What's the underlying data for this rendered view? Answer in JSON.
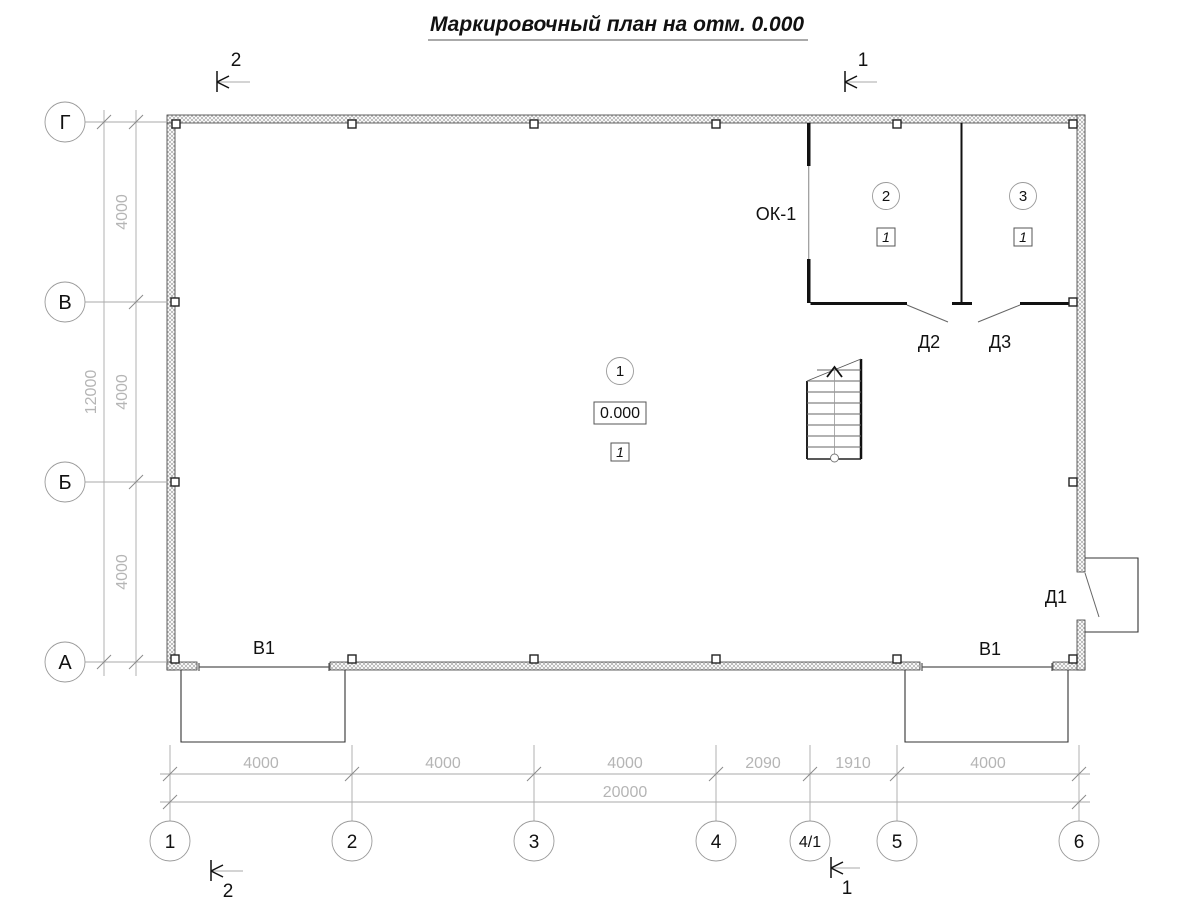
{
  "title": "Маркировочный план на отм. 0.000",
  "section_marks": {
    "top_left": "2",
    "top_right": "1",
    "bottom_left": "2",
    "bottom_right": "1"
  },
  "axes": {
    "vertical": [
      "Г",
      "В",
      "Б",
      "А"
    ],
    "horizontal": [
      "1",
      "2",
      "3",
      "4",
      "4/1",
      "5",
      "6"
    ]
  },
  "dimensions": {
    "left_segments": [
      "4000",
      "4000",
      "4000"
    ],
    "left_total": "12000",
    "bottom_segments": [
      "4000",
      "4000",
      "4000",
      "2090",
      "1910",
      "4000"
    ],
    "bottom_total": "20000"
  },
  "labels": {
    "window": "ОК-1",
    "door_d1": "Д1",
    "door_d2": "Д2",
    "door_d3": "Д3",
    "gate_left": "В1",
    "gate_right": "В1"
  },
  "marks": {
    "hall_number": "1",
    "hall_elevation": "0.000",
    "hall_type": "1",
    "room2_number": "2",
    "room2_type": "1",
    "room3_number": "3",
    "room3_type": "1"
  },
  "colors": {
    "line_dark": "#111111",
    "dim_gray": "#b5b5b5",
    "wall_hatch": "#9a9a9a"
  }
}
